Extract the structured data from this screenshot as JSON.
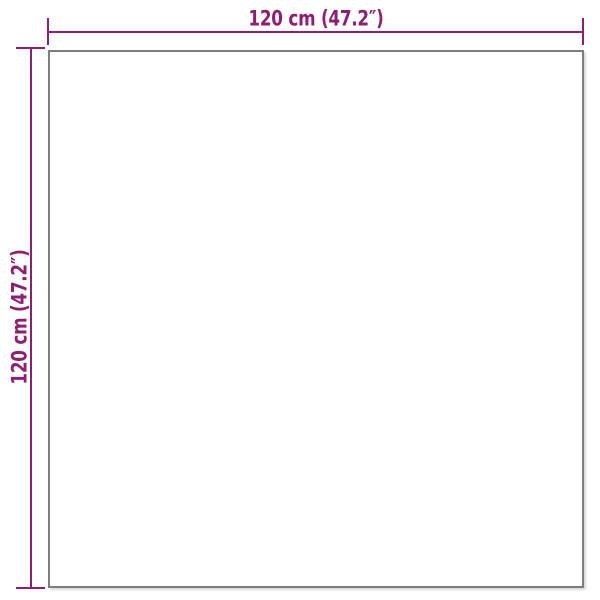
{
  "page": {
    "background": "#ffffff",
    "description": "Product dimension diagram of a square item"
  },
  "colors": {
    "dimension_accent": "#8e1e72",
    "outline_gray": "#7d7d7d",
    "background": "#ffffff"
  },
  "product": {
    "shape": "square-outline"
  },
  "dimensions": {
    "top": {
      "label": "120 cm (47.2″)",
      "value_cm": "120 cm",
      "value_inch": "47.2″"
    },
    "left": {
      "label": "120 cm (47.2″)",
      "value_cm": "120 cm",
      "value_inch": "47.2″"
    }
  }
}
